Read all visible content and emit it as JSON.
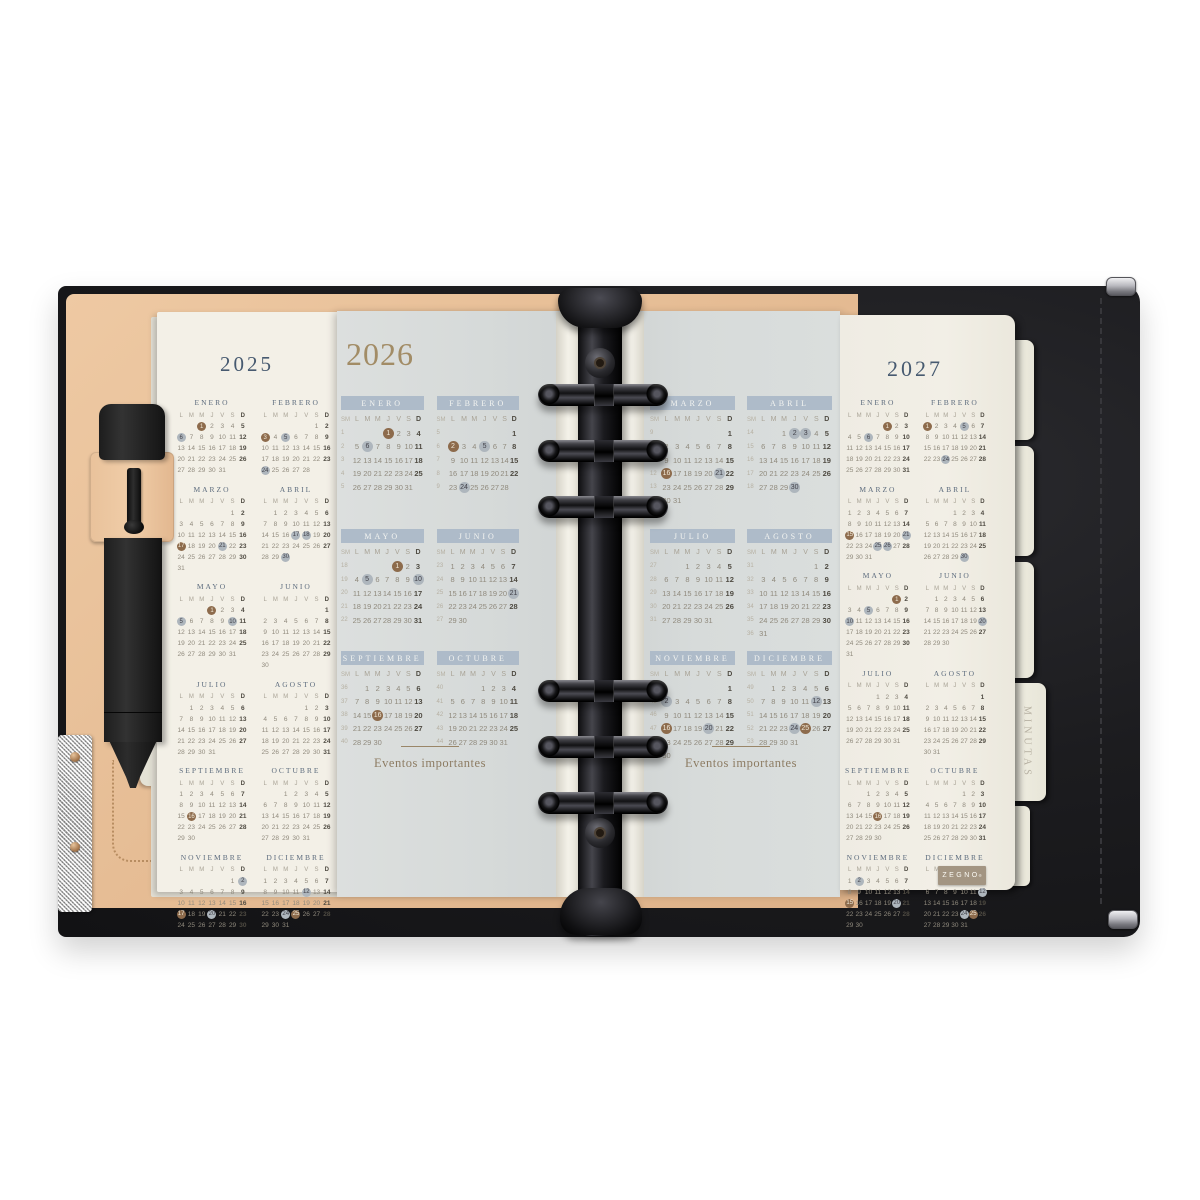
{
  "brand": {
    "logo_text": "ZEGNO",
    "logo_mark": "®"
  },
  "tabs": {
    "minutas_label": "MINUTAS"
  },
  "calendar_2025": {
    "year_title": "2025",
    "weekday_header": [
      "L",
      "M",
      "M",
      "J",
      "V",
      "S",
      "D"
    ],
    "months": [
      {
        "name": "ENERO",
        "first": 2,
        "days": 31,
        "brown": [
          1
        ],
        "gray": [
          6
        ]
      },
      {
        "name": "FEBRERO",
        "first": 5,
        "days": 28,
        "brown": [
          3
        ],
        "gray": [
          5,
          24
        ]
      },
      {
        "name": "MARZO",
        "first": 5,
        "days": 31,
        "brown": [
          17
        ],
        "gray": [
          21
        ]
      },
      {
        "name": "ABRIL",
        "first": 1,
        "days": 30,
        "brown": [],
        "gray": [
          17,
          18,
          30
        ]
      },
      {
        "name": "MAYO",
        "first": 3,
        "days": 31,
        "brown": [
          1
        ],
        "gray": [
          5,
          10
        ]
      },
      {
        "name": "JUNIO",
        "first": 6,
        "days": 30,
        "brown": [],
        "gray": []
      },
      {
        "name": "JULIO",
        "first": 1,
        "days": 31,
        "brown": [],
        "gray": []
      },
      {
        "name": "AGOSTO",
        "first": 4,
        "days": 31,
        "brown": [],
        "gray": []
      },
      {
        "name": "SEPTIEMBRE",
        "first": 0,
        "days": 30,
        "brown": [
          16
        ],
        "gray": []
      },
      {
        "name": "OCTUBRE",
        "first": 2,
        "days": 31,
        "brown": [],
        "gray": []
      },
      {
        "name": "NOVIEMBRE",
        "first": 5,
        "days": 30,
        "brown": [
          17
        ],
        "gray": [
          2,
          20
        ]
      },
      {
        "name": "DICIEMBRE",
        "first": 0,
        "days": 31,
        "brown": [
          25
        ],
        "gray": [
          12,
          24
        ]
      }
    ]
  },
  "calendar_2026": {
    "year_title": "2026",
    "weeknum_header": "SM",
    "weekday_header": [
      "L",
      "M",
      "M",
      "J",
      "V",
      "S",
      "D"
    ],
    "events_label": "Eventos importantes",
    "left_months": [
      {
        "name": "ENERO",
        "first": 3,
        "days": 31,
        "weeks": [
          1,
          2,
          3,
          4,
          5
        ],
        "brown": [
          1
        ],
        "gray": [
          6
        ]
      },
      {
        "name": "FEBRERO",
        "first": 6,
        "days": 28,
        "weeks": [
          5,
          6,
          7,
          8,
          9
        ],
        "brown": [
          2
        ],
        "gray": [
          5,
          24
        ]
      },
      {
        "name": "MAYO",
        "first": 4,
        "days": 31,
        "weeks": [
          18,
          19,
          20,
          21,
          22
        ],
        "brown": [
          1
        ],
        "gray": [
          5,
          10
        ]
      },
      {
        "name": "JUNIO",
        "first": 0,
        "days": 30,
        "weeks": [
          23,
          24,
          25,
          26,
          27
        ],
        "brown": [],
        "gray": [
          21
        ]
      },
      {
        "name": "SEPTIEMBRE",
        "first": 1,
        "days": 30,
        "weeks": [
          36,
          37,
          38,
          39,
          40
        ],
        "brown": [
          16
        ],
        "gray": []
      },
      {
        "name": "OCTUBRE",
        "first": 3,
        "days": 31,
        "weeks": [
          40,
          41,
          42,
          43,
          44
        ],
        "brown": [],
        "gray": []
      }
    ],
    "right_months": [
      {
        "name": "MARZO",
        "first": 6,
        "days": 31,
        "weeks": [
          9,
          10,
          11,
          12,
          13,
          14
        ],
        "brown": [
          16
        ],
        "gray": [
          21
        ]
      },
      {
        "name": "ABRIL",
        "first": 2,
        "days": 30,
        "weeks": [
          14,
          15,
          16,
          17,
          18
        ],
        "brown": [],
        "gray": [
          2,
          3,
          30
        ]
      },
      {
        "name": "JULIO",
        "first": 2,
        "days": 31,
        "weeks": [
          27,
          28,
          29,
          30,
          31
        ],
        "brown": [],
        "gray": []
      },
      {
        "name": "AGOSTO",
        "first": 5,
        "days": 31,
        "weeks": [
          31,
          32,
          33,
          34,
          35,
          36
        ],
        "brown": [],
        "gray": []
      },
      {
        "name": "NOVIEMBRE",
        "first": 6,
        "days": 30,
        "weeks": [
          44,
          45,
          46,
          47,
          48,
          49
        ],
        "brown": [
          16
        ],
        "gray": [
          2,
          20
        ]
      },
      {
        "name": "DICIEMBRE",
        "first": 1,
        "days": 31,
        "weeks": [
          49,
          50,
          51,
          52,
          53
        ],
        "brown": [
          25
        ],
        "gray": [
          12,
          24
        ]
      }
    ]
  },
  "calendar_2027": {
    "year_title": "2027",
    "weekday_header": [
      "L",
      "M",
      "M",
      "J",
      "V",
      "S",
      "D"
    ],
    "months": [
      {
        "name": "ENERO",
        "first": 4,
        "days": 31,
        "brown": [
          1
        ],
        "gray": [
          6
        ]
      },
      {
        "name": "FEBRERO",
        "first": 0,
        "days": 28,
        "brown": [
          1
        ],
        "gray": [
          5,
          24
        ]
      },
      {
        "name": "MARZO",
        "first": 0,
        "days": 31,
        "brown": [
          15
        ],
        "gray": [
          21,
          25,
          26
        ]
      },
      {
        "name": "ABRIL",
        "first": 3,
        "days": 30,
        "brown": [],
        "gray": [
          30
        ]
      },
      {
        "name": "MAYO",
        "first": 5,
        "days": 31,
        "brown": [
          1
        ],
        "gray": [
          5,
          10
        ]
      },
      {
        "name": "JUNIO",
        "first": 1,
        "days": 30,
        "brown": [],
        "gray": [
          20
        ]
      },
      {
        "name": "JULIO",
        "first": 3,
        "days": 31,
        "brown": [],
        "gray": []
      },
      {
        "name": "AGOSTO",
        "first": 6,
        "days": 31,
        "brown": [],
        "gray": []
      },
      {
        "name": "SEPTIEMBRE",
        "first": 2,
        "days": 30,
        "brown": [
          16
        ],
        "gray": []
      },
      {
        "name": "OCTUBRE",
        "first": 4,
        "days": 31,
        "brown": [],
        "gray": []
      },
      {
        "name": "NOVIEMBRE",
        "first": 0,
        "days": 30,
        "brown": [
          15
        ],
        "gray": [
          2,
          20
        ]
      },
      {
        "name": "DICIEMBRE",
        "first": 2,
        "days": 31,
        "brown": [
          25
        ],
        "gray": [
          12,
          24
        ]
      }
    ]
  },
  "colors": {
    "holiday_circle": "#8d6b4c",
    "observance_circle": "#aeb6bd",
    "month_band_blue": "#aebbc9",
    "year_title_blue": "#475a70",
    "year_title_gold": "#a28c66",
    "leather_tan": "#e6bd95",
    "cover_black": "#1c1c1f",
    "page_cream": "#f2efe6",
    "page_gray": "#d7dbda"
  }
}
